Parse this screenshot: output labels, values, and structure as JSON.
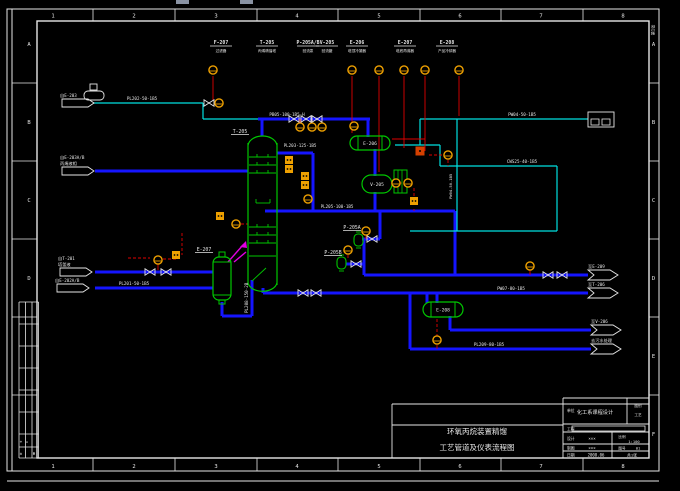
{
  "meta": {
    "app": "CAD P&ID drawing",
    "colors": {
      "pipe_blue": "#1515ff",
      "utility_cyan": "#00e0e0",
      "equipment_green": "#00c800",
      "signal_red": "#e00000",
      "feed_magenta": "#e000e0",
      "instrument_orange": "#eea000",
      "frame_white": "#e6e6e6",
      "artifact_gray": "#8a93a3"
    }
  },
  "frame": {
    "col_labels": [
      "1",
      "2",
      "3",
      "4",
      "5",
      "6",
      "7",
      "8"
    ],
    "col_xs": [
      53,
      134,
      216,
      297,
      379,
      460,
      541,
      623
    ],
    "col_tick_xs": [
      93,
      175,
      257,
      338,
      420,
      501,
      583
    ],
    "row_labels_left": [
      "A",
      "B",
      "C",
      "D"
    ],
    "row_labels_right": [
      "A",
      "B",
      "C",
      "D",
      "E",
      "F"
    ],
    "row_ys": [
      44,
      122,
      200,
      278,
      356,
      434
    ],
    "row_tick_ys": [
      83,
      161,
      239,
      317,
      395
    ],
    "corner_label": "第1张"
  },
  "artifacts": [
    {
      "x": 176,
      "y": 0,
      "w": 13,
      "h": 4
    },
    {
      "x": 240,
      "y": 0,
      "w": 13,
      "h": 4
    }
  ],
  "top_tags": [
    {
      "tag": "F-207",
      "desc": "过滤器",
      "x": 221
    },
    {
      "tag": "T-205",
      "desc": "丙烯精馏塔",
      "x": 267
    },
    {
      "tag": "P-205A/B",
      "desc": "回流泵",
      "x": 308
    },
    {
      "tag": "V-205",
      "desc": "回流罐",
      "x": 327
    },
    {
      "tag": "E-206",
      "desc": "塔顶冷凝器",
      "x": 357
    },
    {
      "tag": "E-207",
      "desc": "塔底再沸器",
      "x": 405
    },
    {
      "tag": "E-208",
      "desc": "产品冷却器",
      "x": 447
    }
  ],
  "equipment": [
    {
      "type": "column",
      "tag": "T-205",
      "x": 248,
      "y": 143,
      "w": 29,
      "h": 142
    },
    {
      "type": "hx_h",
      "tag": "E-206",
      "x": 350,
      "y": 136,
      "w": 40,
      "h": 14
    },
    {
      "type": "drum_h",
      "tag": "V-205",
      "x": 362,
      "y": 175,
      "w": 30,
      "h": 18
    },
    {
      "type": "box_v",
      "tag": "",
      "x": 394,
      "y": 170,
      "w": 13,
      "h": 23
    },
    {
      "type": "vessel_v",
      "tag": "E-207",
      "x": 213,
      "y": 257,
      "w": 18,
      "h": 43
    },
    {
      "type": "hx_h",
      "tag": "E-208",
      "x": 423,
      "y": 302,
      "w": 40,
      "h": 15
    },
    {
      "type": "capsule_v",
      "tag": "P-205A",
      "x": 354,
      "y": 234,
      "w": 9,
      "h": 12
    },
    {
      "type": "capsule_v",
      "tag": "P-205B",
      "x": 337,
      "y": 257,
      "w": 9,
      "h": 12
    }
  ],
  "equip_labels": [
    {
      "t": "T-205",
      "x": 240,
      "y": 133,
      "u": 1
    },
    {
      "t": "E-207",
      "x": 204,
      "y": 251,
      "u": 1
    },
    {
      "t": "P-205A",
      "x": 352,
      "y": 229,
      "u": 1
    },
    {
      "t": "P-205B",
      "x": 333,
      "y": 254,
      "u": 1
    }
  ],
  "pipe_labels": [
    {
      "t": "PL202-50-1B5",
      "x": 142,
      "y": 100
    },
    {
      "t": "PB05-100-1B5-H",
      "x": 287,
      "y": 116
    },
    {
      "t": "PL203-125-1B5",
      "x": 300,
      "y": 147
    },
    {
      "t": "PW04-50-1B5",
      "x": 522,
      "y": 116
    },
    {
      "t": "CWS25-40-1B5",
      "x": 522,
      "y": 163
    },
    {
      "t": "PL205-100-1B5",
      "x": 337,
      "y": 208
    },
    {
      "t": "PL208-150-2B",
      "x": 248,
      "y": 313,
      "rot": -90
    },
    {
      "t": "PW04-50-1B5",
      "x": 452,
      "y": 199,
      "rot": -90,
      "s": 3.8
    },
    {
      "t": "PL201-50-1B5",
      "x": 134,
      "y": 285
    },
    {
      "t": "PW07-80-1B5",
      "x": 511,
      "y": 290
    },
    {
      "t": "PL209-80-1B5",
      "x": 489,
      "y": 346
    }
  ],
  "flags": {
    "left": [
      {
        "x": 62,
        "y": 103,
        "lines": [
          "自E-203"
        ],
        "symbol": true
      },
      {
        "x": 62,
        "y": 171,
        "lines": [
          "自E-203A/B",
          "丙烯液相"
        ]
      },
      {
        "x": 60,
        "y": 272,
        "lines": [
          "自T-201",
          "塔釜液"
        ]
      },
      {
        "x": 57,
        "y": 288,
        "lines": [
          "自E-202A/B"
        ]
      }
    ],
    "right": [
      {
        "x": 588,
        "y": 275,
        "lines": [
          "至E-209"
        ]
      },
      {
        "x": 588,
        "y": 293,
        "lines": [
          "至T-206"
        ]
      },
      {
        "x": 591,
        "y": 330,
        "lines": [
          "至V-206"
        ]
      },
      {
        "x": 591,
        "y": 349,
        "lines": [
          "去污水处理"
        ]
      }
    ],
    "box": {
      "x": 588,
      "y": 112,
      "w": 26,
      "h": 15
    }
  },
  "pipes": {
    "blue": [
      [
        258,
        119,
        370,
        119
      ],
      [
        262,
        119,
        262,
        136
      ],
      [
        368,
        119,
        368,
        137
      ],
      [
        375,
        149,
        375,
        176
      ],
      [
        375,
        192,
        375,
        211
      ],
      [
        265,
        211,
        455,
        211
      ],
      [
        277,
        153,
        313,
        153
      ],
      [
        313,
        153,
        313,
        211
      ],
      [
        455,
        211,
        455,
        275
      ],
      [
        364,
        275,
        588,
        275
      ],
      [
        364,
        264,
        364,
        275
      ],
      [
        263,
        288,
        263,
        293
      ],
      [
        263,
        293,
        588,
        293
      ],
      [
        427,
        293,
        427,
        303
      ],
      [
        437,
        293,
        437,
        303
      ],
      [
        450,
        316,
        450,
        330
      ],
      [
        450,
        330,
        591,
        330
      ],
      [
        410,
        293,
        410,
        349
      ],
      [
        410,
        349,
        591,
        349
      ],
      [
        95,
        171,
        248,
        171
      ],
      [
        95,
        272,
        213,
        272
      ],
      [
        95,
        288,
        213,
        288
      ],
      [
        222,
        302,
        222,
        316
      ],
      [
        222,
        316,
        252,
        316
      ],
      [
        252,
        280,
        252,
        316
      ],
      [
        380,
        211,
        380,
        239
      ],
      [
        362,
        239,
        380,
        239
      ],
      [
        364,
        239,
        364,
        264
      ],
      [
        346,
        264,
        364,
        264
      ]
    ],
    "cyan": [
      [
        93,
        103,
        203,
        103
      ],
      [
        203,
        103,
        203,
        119
      ],
      [
        203,
        119,
        258,
        119
      ],
      [
        395,
        145,
        440,
        145
      ],
      [
        420,
        119,
        420,
        145
      ],
      [
        420,
        119,
        588,
        119
      ],
      [
        457,
        119,
        457,
        231
      ],
      [
        440,
        145,
        440,
        166
      ],
      [
        440,
        166,
        557,
        166
      ],
      [
        557,
        166,
        557,
        231
      ],
      [
        410,
        231,
        557,
        231
      ]
    ],
    "red": [
      [
        213,
        76,
        213,
        100
      ],
      [
        352,
        76,
        352,
        133
      ],
      [
        379,
        76,
        379,
        172
      ],
      [
        404,
        76,
        404,
        148
      ],
      [
        425,
        76,
        425,
        151
      ],
      [
        459,
        76,
        459,
        116
      ],
      [
        392,
        139,
        425,
        139
      ],
      [
        414,
        209,
        414,
        211
      ],
      [
        437,
        345,
        437,
        349
      ],
      [
        530,
        270,
        530,
        275
      ],
      [
        300,
        119,
        300,
        123
      ],
      [
        312,
        119,
        312,
        123
      ],
      [
        322,
        119,
        322,
        123
      ],
      [
        366,
        236,
        366,
        239
      ],
      [
        348,
        255,
        348,
        258
      ],
      [
        158,
        264,
        158,
        270
      ]
    ],
    "red_dash": [
      [
        429,
        155,
        443,
        155
      ],
      [
        448,
        160,
        448,
        166
      ],
      [
        399,
        183,
        404,
        183
      ],
      [
        414,
        188,
        414,
        197
      ],
      [
        241,
        224,
        248,
        224
      ],
      [
        128,
        258,
        150,
        258
      ],
      [
        182,
        233,
        182,
        255
      ],
      [
        163,
        259,
        176,
        259
      ],
      [
        437,
        319,
        437,
        336
      ]
    ],
    "magenta": [
      [
        228,
        262,
        243,
        245
      ],
      [
        234,
        262,
        246,
        252
      ]
    ],
    "magenta_arrow": "246,241 240,247 247,248"
  },
  "symbols": {
    "valves": [
      [
        209,
        103
      ],
      [
        294,
        119
      ],
      [
        306,
        119
      ],
      [
        317,
        119
      ],
      [
        150,
        272
      ],
      [
        166,
        272
      ],
      [
        303,
        293
      ],
      [
        316,
        293
      ],
      [
        548,
        275
      ],
      [
        562,
        275
      ],
      [
        372,
        239
      ],
      [
        356,
        264
      ]
    ],
    "circles": [
      [
        219,
        103
      ],
      [
        300,
        127
      ],
      [
        312,
        127
      ],
      [
        322,
        127
      ],
      [
        354,
        126
      ],
      [
        308,
        199
      ],
      [
        396,
        183
      ],
      [
        408,
        183
      ],
      [
        366,
        231
      ],
      [
        348,
        250
      ],
      [
        158,
        260
      ],
      [
        236,
        224
      ],
      [
        530,
        266
      ],
      [
        437,
        340
      ],
      [
        448,
        155
      ],
      [
        213,
        70
      ],
      [
        352,
        70
      ],
      [
        379,
        70
      ],
      [
        404,
        70
      ],
      [
        425,
        70
      ],
      [
        459,
        70
      ]
    ],
    "squares": [
      [
        289,
        160
      ],
      [
        289,
        169
      ],
      [
        305,
        176
      ],
      [
        305,
        185
      ],
      [
        414,
        201
      ],
      [
        176,
        255
      ],
      [
        220,
        216
      ]
    ],
    "red_squares": [
      [
        420,
        151
      ]
    ]
  },
  "title_block": {
    "line1": "环氧丙烷装置精馏",
    "line2": "工艺管道及仪表流程图",
    "r1_label": "单位",
    "r1_value": "化工系课程设计",
    "r1_cell": [
      "图别",
      "工艺"
    ],
    "r2_label": "工程",
    "r3_label": "设计",
    "r3_value": "×××",
    "r3_cell_label": "比例",
    "r3_cell_value": "1:100",
    "r4_label": "制图",
    "r4_value": "×××",
    "r4_cell_label": "图号",
    "r4_cell_value": "01",
    "r5_label": "日期",
    "r5_value": "2008.06",
    "r5_cell": "共1张"
  },
  "rev_table": {
    "marks": [
      {
        "t": "+",
        "x": 21,
        "y": 443
      },
      {
        "t": "=",
        "x": 27,
        "y": 443
      },
      {
        "t": "±",
        "x": 21,
        "y": 455
      },
      {
        "t": "Φ",
        "x": 34,
        "y": 455
      }
    ]
  }
}
